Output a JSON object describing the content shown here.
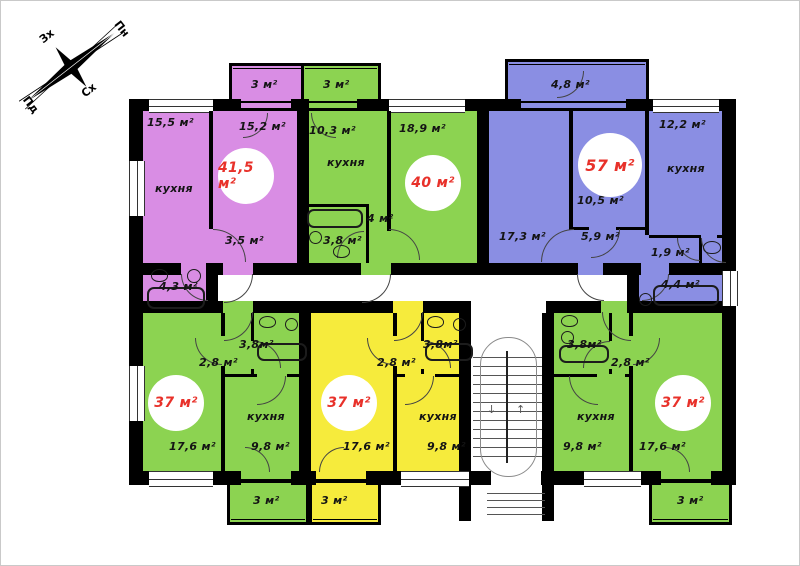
{
  "compass": {
    "north": "Пн",
    "east": "Сх",
    "south": "Пд",
    "west": "Зх"
  },
  "palette": {
    "pink": "#d98de4",
    "green": "#8cd351",
    "blue": "#8a8ee3",
    "yellow": "#f6eb3c",
    "wall": "#000000",
    "area_text": "#e8312a"
  },
  "apartments": [
    {
      "id": "top-left-41.5",
      "color": "#d98de4",
      "total": "41,5 м²",
      "labels": {
        "balcony": "3 м²",
        "room1": "15,5 м²",
        "kitchen_word": "кухня",
        "room2": "15,2 м²",
        "hall": "3,5 м²",
        "bath": "4,3 м²"
      }
    },
    {
      "id": "top-middle-40",
      "color": "#8cd351",
      "total": "40 м²",
      "labels": {
        "balcony": "3 м²",
        "kitchen": "10,3 м²",
        "kitchen_word": "кухня",
        "room": "18,9 м²",
        "hall": "4 м²",
        "bath": "3,8 м²"
      }
    },
    {
      "id": "top-right-57",
      "color": "#8a8ee3",
      "total": "57 м²",
      "labels": {
        "balcony": "4,8 м²",
        "kitchen": "12,2 м²",
        "kitchen_word": "кухня",
        "room_mid": "10,5 м²",
        "room_left": "17,3 м²",
        "hall": "5,9 м²",
        "wc": "1,9 м²",
        "bath": "4,4 м²"
      }
    },
    {
      "id": "bottom-left-37",
      "color": "#8cd351",
      "total": "37 м²",
      "labels": {
        "hall": "2,8 м²",
        "bath": "3,8м²",
        "room": "17,6 м²",
        "kitchen_word": "кухня",
        "kitchen": "9,8 м²",
        "balcony": "3 м²"
      }
    },
    {
      "id": "bottom-middle-37",
      "color": "#f6eb3c",
      "total": "37 м²",
      "labels": {
        "hall": "2,8 м²",
        "bath": "3,8м²",
        "room": "17,6 м²",
        "kitchen_word": "кухня",
        "kitchen": "9,8 м²",
        "balcony": "3 м²"
      }
    },
    {
      "id": "bottom-right-37",
      "color": "#8cd351",
      "total": "37 м²",
      "labels": {
        "bath": "3,8м²",
        "hall": "2,8 м²",
        "kitchen_word": "кухня",
        "kitchen": "9,8 м²",
        "room": "17,6 м²",
        "balcony": "3 м²"
      }
    }
  ]
}
